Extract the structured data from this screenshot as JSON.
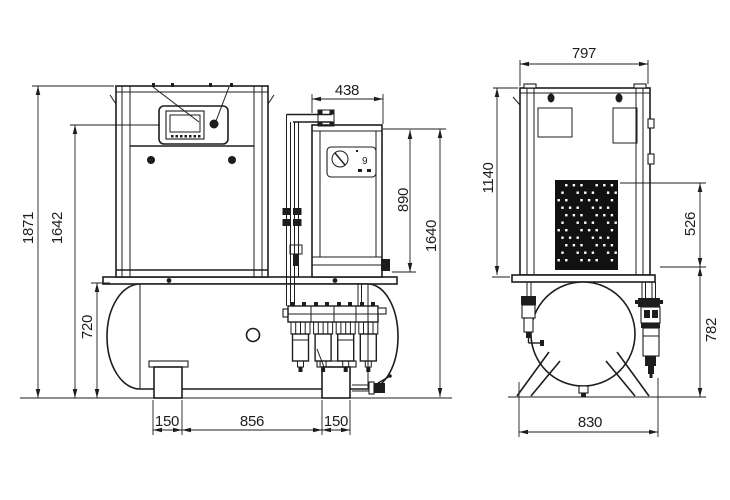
{
  "drawing": {
    "type": "technical-dimension-drawing",
    "subject": "screw air compressor on receiver tank with dryer and filter battery, front and side views",
    "line_color": "#1d1d1d",
    "background": "#ffffff",
    "views": {
      "front": {
        "dimensions": {
          "overall_height": "1871",
          "display_height": "1642",
          "tank_height": "720",
          "dryer_width": "438",
          "dryer_height": "890",
          "dryer_top_height": "1640",
          "left_foot_width": "150",
          "feet_spacing": "856",
          "right_foot_width": "150"
        },
        "dryer_panel_digit": "9"
      },
      "side": {
        "dimensions": {
          "cabinet_width": "797",
          "cabinet_height": "1140",
          "grille_height": "526",
          "tank_top_height": "782",
          "base_width": "830"
        }
      }
    }
  }
}
